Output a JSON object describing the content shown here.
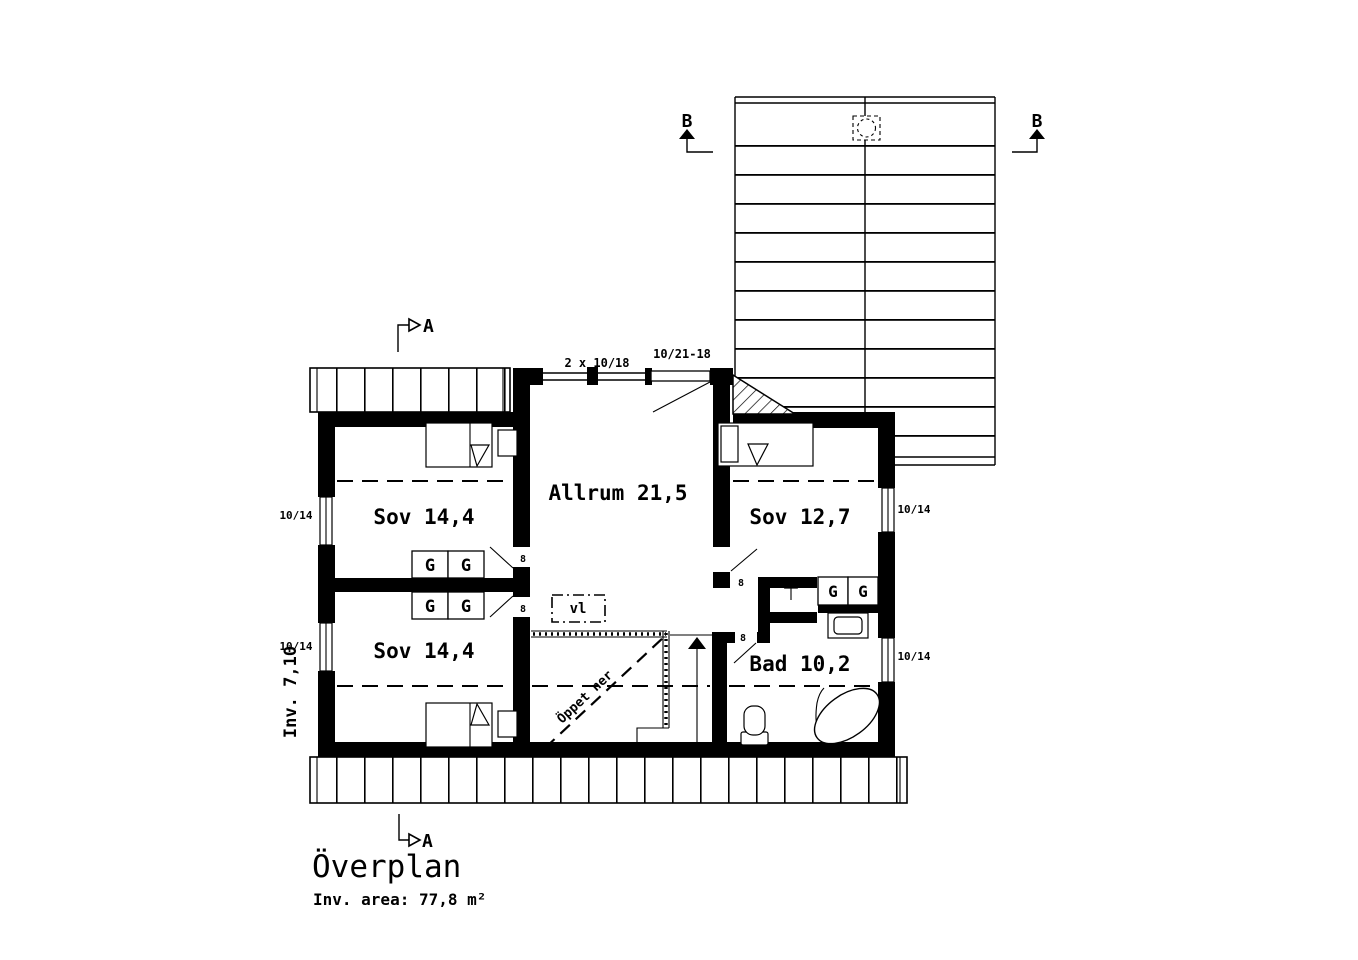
{
  "drawing": {
    "title": "Överplan",
    "area_label": "Inv. area: 77,8 m²",
    "interior_height_label": "Inv. 7,10"
  },
  "rooms": {
    "sov_top_left": "Sov 14,4",
    "sov_bottom_left": "Sov 14,4",
    "allrum": "Allrum 21,5",
    "sov_right": "Sov 12,7",
    "bad": "Bad 10,2"
  },
  "openings": {
    "window_left_top": "10/14",
    "window_left_bottom": "10/14",
    "window_right_top": "10/14",
    "window_right_bottom": "10/14",
    "window_top": "2 x 10/18",
    "balcony_door": "10/21-18",
    "door_widths": [
      "8",
      "8",
      "8",
      "8"
    ]
  },
  "annotations": {
    "closets": [
      "G",
      "G",
      "G",
      "G",
      "G",
      "G"
    ],
    "vl": "vl",
    "open_below": "Öppet ner",
    "section_a": "A",
    "section_b": "B"
  },
  "colors": {
    "line": "#000000",
    "background": "#ffffff"
  }
}
